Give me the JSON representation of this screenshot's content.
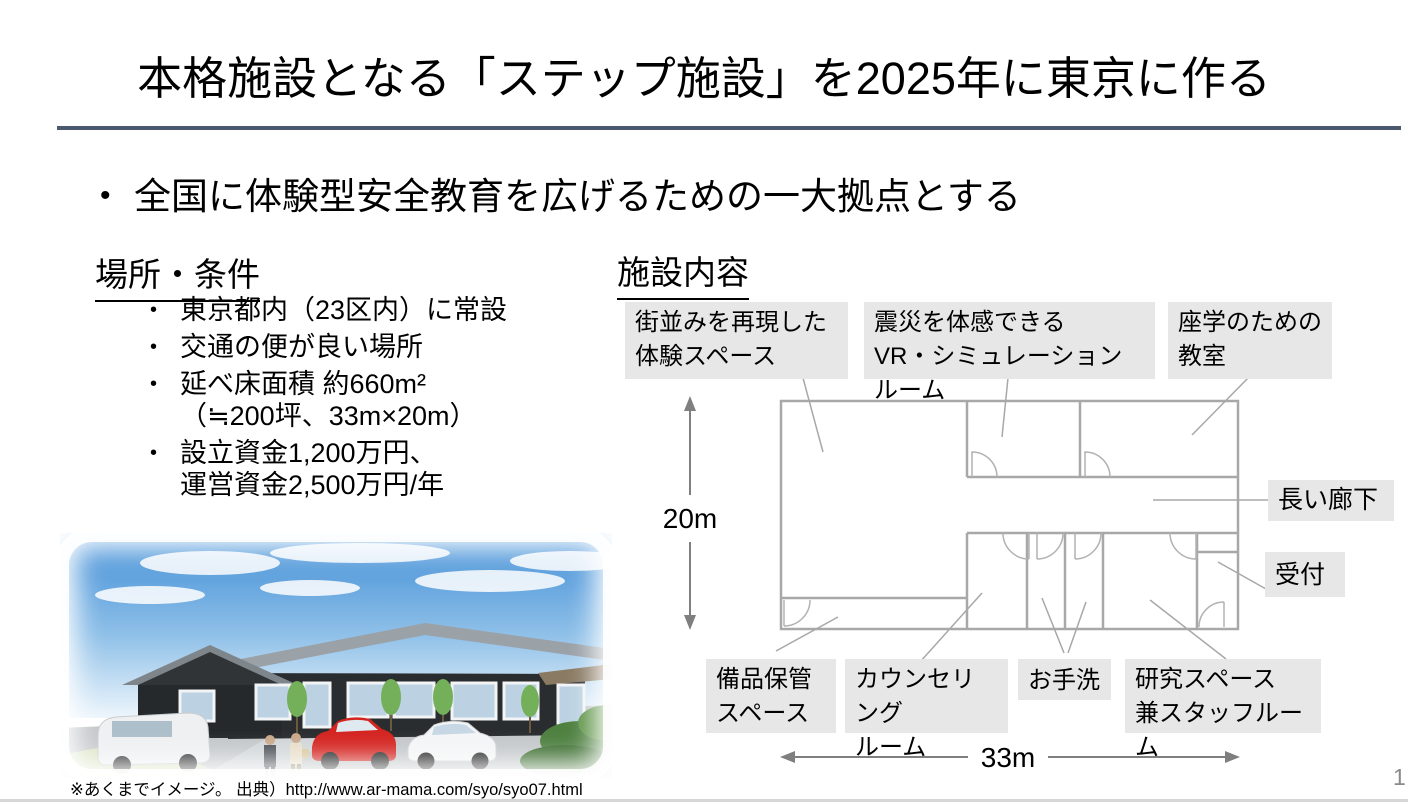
{
  "slide": {
    "title": "本格施設となる「ステップ施設」を2025年に東京に作る",
    "main_bullet": "全国に体験型安全教育を広げるための一大拠点とする",
    "footnote": "※あくまでイメージ。 出典）http://www.ar-mama.com/syo/syo07.html",
    "page_number": "1"
  },
  "location": {
    "heading": "場所・条件",
    "items": [
      {
        "text": "東京都内（23区内）に常設",
        "cont": ""
      },
      {
        "text": "交通の便が良い場所",
        "cont": ""
      },
      {
        "text": "延べ床面積 約660m²",
        "cont": "（≒200坪、33m×20m）"
      },
      {
        "text": "設立資金1,200万円、",
        "cont": "運営資金2,500万円/年"
      }
    ]
  },
  "facility": {
    "heading": "施設内容",
    "labels": {
      "machinami": "街並みを再現した\n体験スペース",
      "vr": "震災を体感できる\nVR・シミュレーションルーム",
      "zagaku": "座学のための\n教室",
      "corridor": "長い廊下",
      "reception": "受付",
      "storage": "備品保管\nスペース",
      "counseling": "カウンセリング\nルーム",
      "toilet": "お手洗",
      "research": "研究スペース\n兼スタッフルーム"
    },
    "dimensions": {
      "height_label": "20m",
      "width_label": "33m"
    }
  },
  "colors": {
    "accent_rule": "#4a5a6e",
    "label_background": "#e7e7e7",
    "plan_line": "#a8a8a8",
    "dimension_line": "#7f7f7f"
  }
}
